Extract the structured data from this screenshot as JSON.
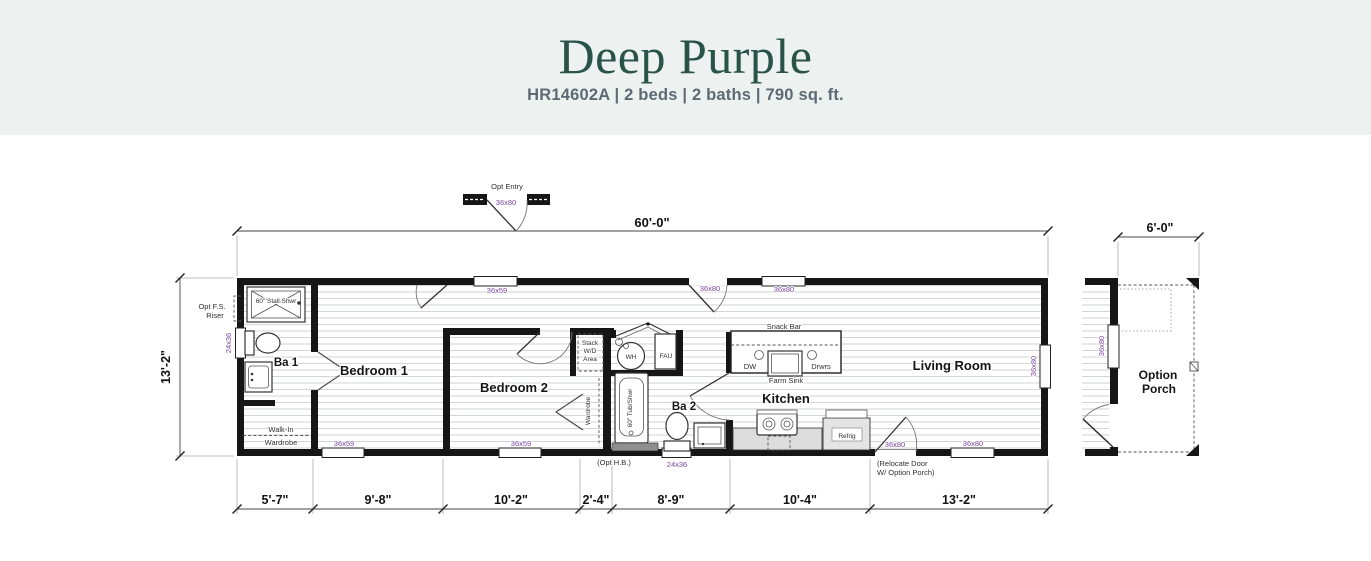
{
  "header": {
    "title": "Deep Purple",
    "subtitle": "HR14602A | 2 beds | 2 baths | 790 sq. ft."
  },
  "dimensions": {
    "width_top": "60'-0\"",
    "height_left": "13'-2\"",
    "porch_width": "6'-0\"",
    "bottom": [
      "5'-7\"",
      "9'-8\"",
      "10'-2\"",
      "2'-4\"",
      "8'-9\"",
      "10'-4\"",
      "13'-2\""
    ]
  },
  "rooms": {
    "ba1": "Ba 1",
    "bedroom1": "Bedroom 1",
    "bedroom2": "Bedroom 2",
    "ba2": "Ba 2",
    "kitchen": "Kitchen",
    "living_room": "Living Room",
    "porch_line1": "Option",
    "porch_line2": "Porch"
  },
  "fixtures": {
    "stall_shower": "60\" Stall Shwr",
    "walkin_line1": "Walk-In",
    "walkin_line2": "Wardrobe",
    "stack_line1": "Stack",
    "stack_line2": "W/D",
    "stack_line3": "Area",
    "water_heater": "WH",
    "fau": "FAU",
    "wardrobe": "Wardrobe",
    "tub_shower": "60\" Tub/Shwr",
    "snack_bar": "Snack Bar",
    "dishwasher": "DW",
    "farm_sink": "Farm Sink",
    "drawers": "Drwrs",
    "refrigerator": "Refrig"
  },
  "notes": {
    "opt_entry": "Opt Entry",
    "opt_fs_line1": "Opt F.S.",
    "opt_fs_line2": "Riser",
    "opt_hb": "(Opt H.B.)",
    "relocate_line1": "(Relocate Door",
    "relocate_line2": "W/ Option Porch)"
  },
  "openings": {
    "opt_entry_door": "36x80",
    "entry_window": "36x59",
    "rear_door": "36x80",
    "kitchen_window": "36x80",
    "bath1_window": "24x36",
    "bedroom1_window": "36x59",
    "bedroom2_window": "36x59",
    "bath2_window": "24x36",
    "front_door": "36x80",
    "living_window_bottom": "36x80",
    "living_window_right": "36x80",
    "porch_window": "36x80"
  },
  "colors": {
    "title_green": "#2a5348",
    "subtitle_gray": "#5d6a74",
    "label_purple": "#7b45a1",
    "header_bg": "#edf2f0",
    "wall_black": "#161616"
  }
}
